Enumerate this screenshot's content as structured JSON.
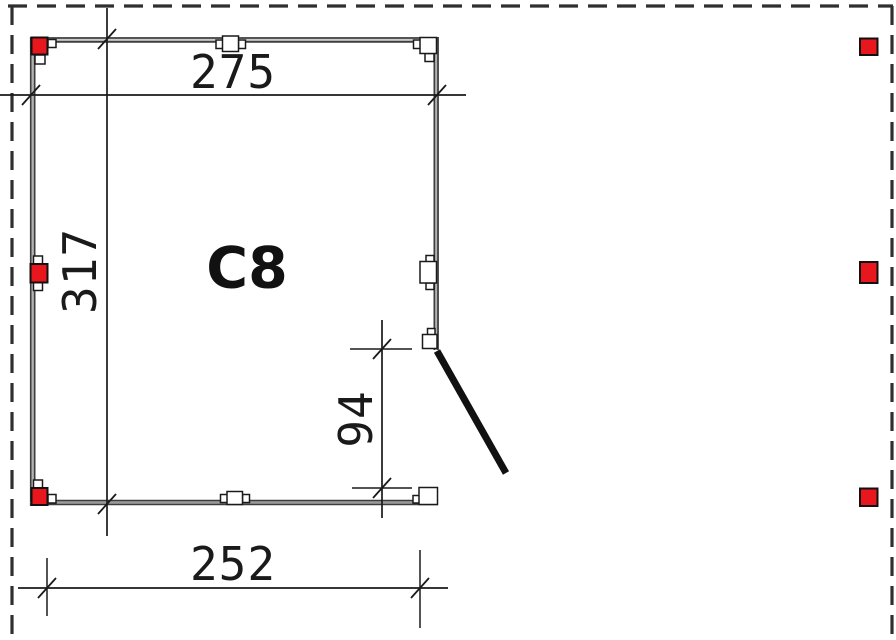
{
  "plan": {
    "room_label": "C8",
    "dimensions": {
      "top": "275",
      "left": "317",
      "door": "94",
      "bottom": "252"
    }
  },
  "colors": {
    "marker_red": "#e8161d",
    "wall_gray": "#3d3d3d",
    "line_black": "#1a1a1a",
    "border_gray": "#2f2f2f"
  },
  "icons": {
    "red_square_marker": "post-position-marker",
    "door_arc": "door-leaf-stroke"
  }
}
